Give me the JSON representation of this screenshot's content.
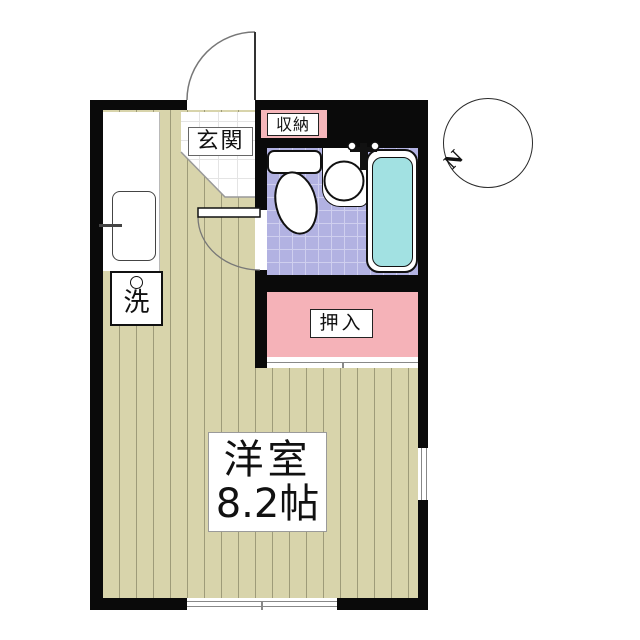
{
  "floorplan": {
    "rooms": {
      "main": {
        "name_label": "洋室",
        "size_label": "8.2帖"
      },
      "entrance": {
        "label": "玄関"
      },
      "storage": {
        "label": "収納"
      },
      "closet": {
        "label": "押入"
      },
      "laundry": {
        "label": "洗"
      }
    },
    "compass": {
      "north_label": "N"
    },
    "icons": {
      "toilet": "toilet-icon",
      "sink": "sink-icon",
      "bathtub": "bathtub-icon",
      "kitchen_sink": "kitchen-sink-icon",
      "washing_machine": "washing-machine-icon",
      "entrance_door": "door-swing-arc-icon",
      "bathroom_door": "door-swing-arc-icon",
      "compass_needle": "compass-needle-icon",
      "window": "window-icon"
    },
    "colors": {
      "wall": "#0a0a0a",
      "floor-base": "#d8d4ab",
      "floor-stripe": "#9e9b79",
      "tile-base": "#b2b2e2",
      "tile-grid": "#cfcfef",
      "bathtub-water": "#a2e1e2",
      "closet-pink": "#f5b2b8",
      "storage-pink": "#f5b6ba"
    }
  }
}
